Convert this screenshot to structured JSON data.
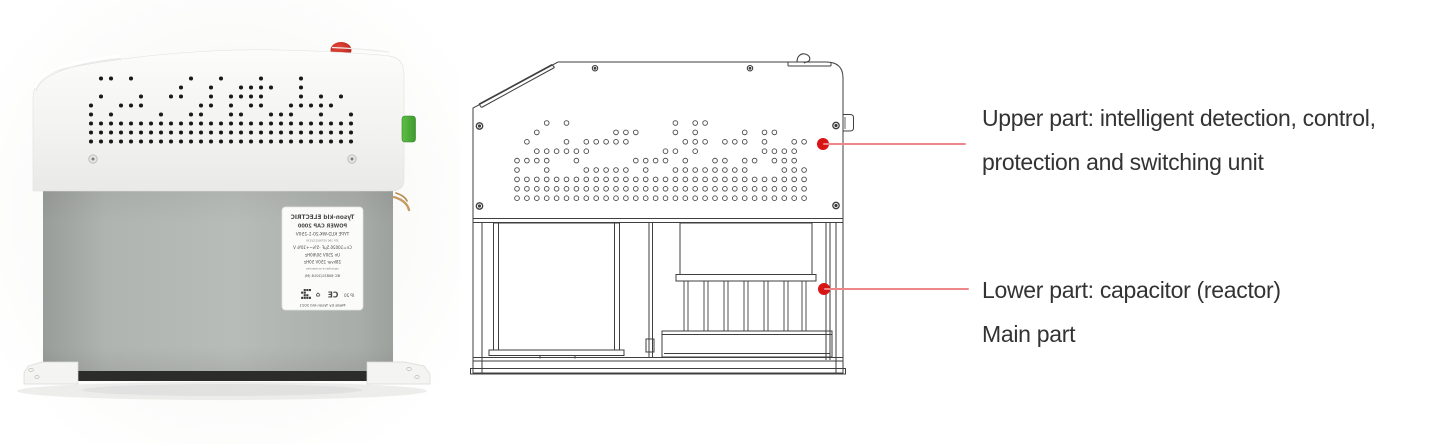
{
  "colors": {
    "callout_dot": "#d81414",
    "callout_line": "#ee8888",
    "annotation_text": "#333333",
    "drawing_stroke": "#3f3f3f",
    "button_red": "#c5281c",
    "connector_green": "#4fae3d"
  },
  "photo": {
    "description": "power-capacitor-product-photo",
    "label": {
      "lines": [
        {
          "text": "Tyson-kld ELECTRIC",
          "size": 5.8,
          "bold": true
        },
        {
          "text": "POWER CAP 2000",
          "size": 5.0,
          "bold": true
        },
        {
          "text": "TYPE KLD-WK-20-1-250V",
          "size": 4.4,
          "bold": false
        },
        {
          "text": "3TA 190 03790/123/139",
          "size": 2.7,
          "bold": false
        },
        {
          "text": "Cn=10026.5µF  -5%~+10%  V",
          "size": 4.0,
          "bold": false
        },
        {
          "text": "Un 250V   50/60Hz",
          "size": 4.0,
          "bold": false
        },
        {
          "text": "28kvar  250V  50Hz",
          "size": 4.0,
          "bold": false
        },
        {
          "text": "capacitance accessories",
          "size": 2.7,
          "bold": false
        },
        {
          "text": "IEC 60831/2016  (M)",
          "size": 3.6,
          "bold": false
        },
        {
          "text": "IP 20",
          "size": 4.0,
          "bold": false,
          "marks_row": true
        },
        {
          "text": "Made by Tyson-kld     2021",
          "size": 3.8,
          "bold": false
        }
      ]
    }
  },
  "annotations": {
    "upper": {
      "line1": "Upper part: intelligent detection, control,",
      "line2": "protection and switching unit"
    },
    "lower": {
      "line1": "Lower part: capacitor (reactor)",
      "line2": "Main part"
    }
  }
}
